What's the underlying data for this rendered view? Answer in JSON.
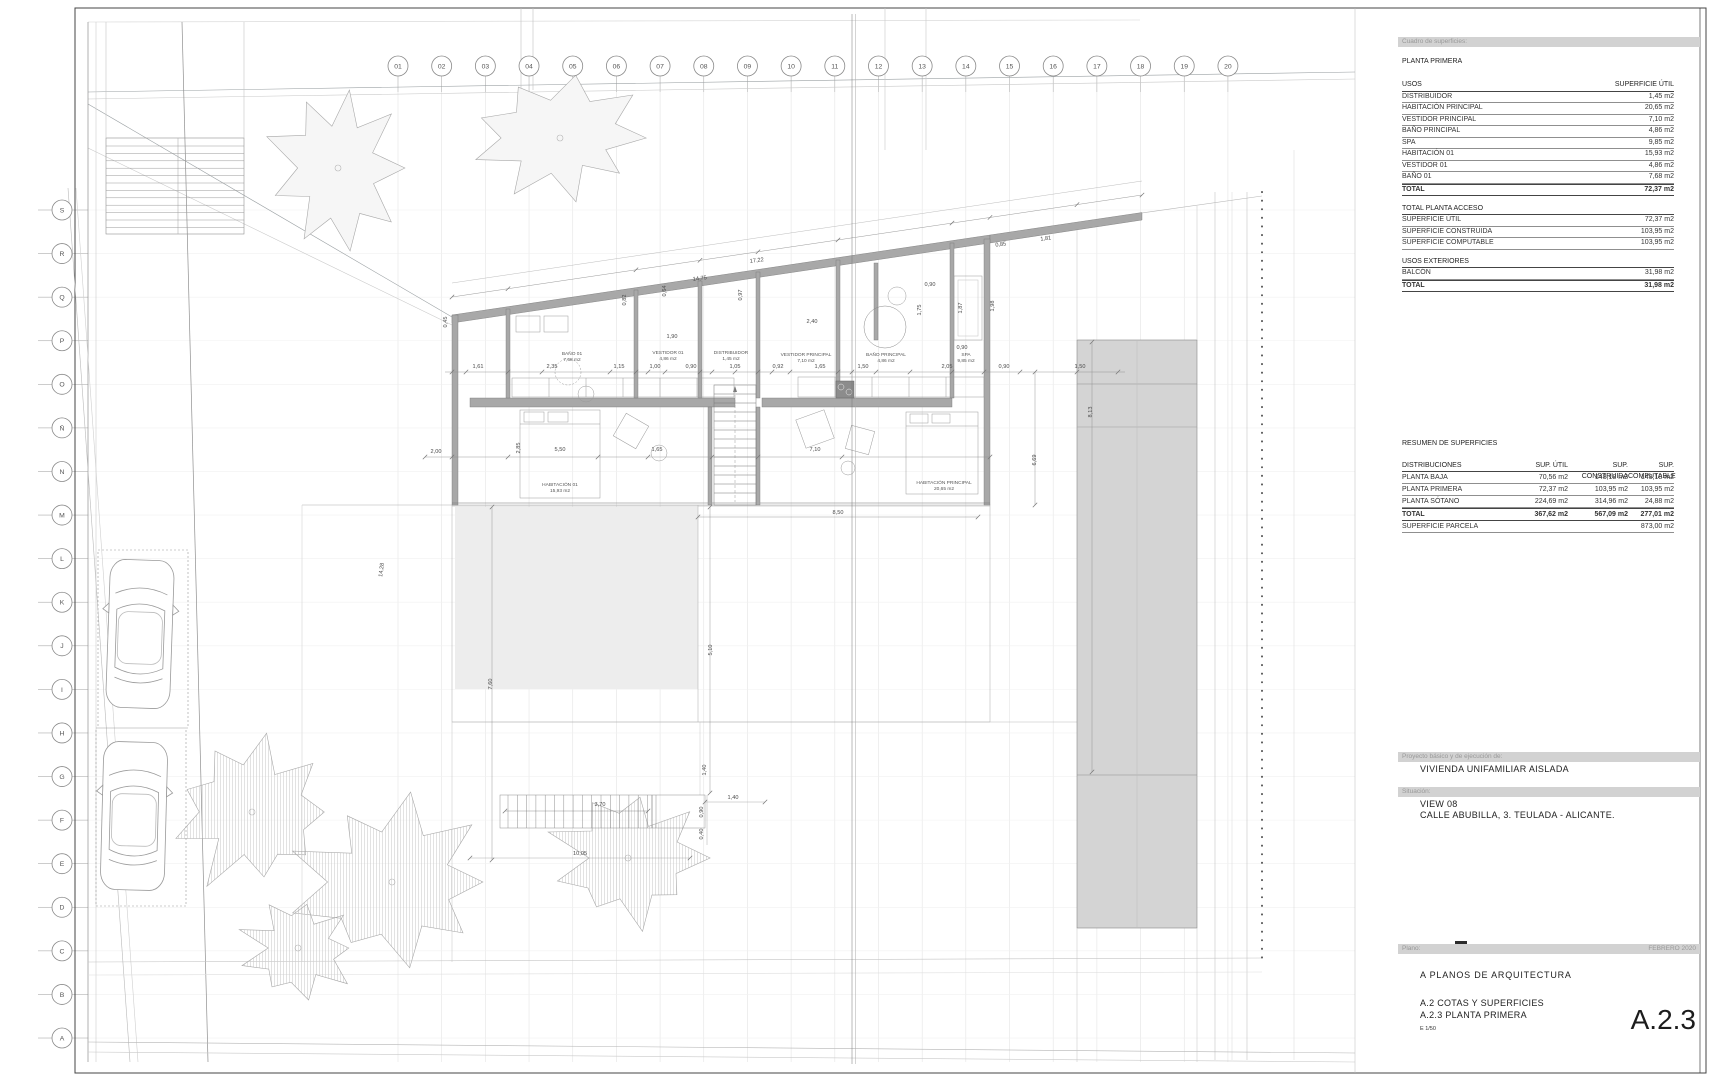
{
  "sheet": {
    "width": 1718,
    "height": 1080
  },
  "title_block": {
    "cuadro_label": "Cuadro de superficies:",
    "planta_title": "PLANTA PRIMERA",
    "usos_table": {
      "col1": "USOS",
      "col2": "SUPERFICIE ÚTIL",
      "rows": [
        [
          "DISTRIBUIDOR",
          "1,45 m2"
        ],
        [
          "HABITACIÓN PRINCIPAL",
          "20,65 m2"
        ],
        [
          "VESTIDOR PRINCIPAL",
          "7,10 m2"
        ],
        [
          "BAÑO PRINCIPAL",
          "4,86 m2"
        ],
        [
          "SPA",
          "9,85 m2"
        ],
        [
          "HABITACIÓN 01",
          "15,93 m2"
        ],
        [
          "VESTIDOR 01",
          "4,86 m2"
        ],
        [
          "BAÑO 01",
          "7,68 m2"
        ]
      ],
      "total": [
        "TOTAL",
        "72,37 m2"
      ]
    },
    "acceso_table": {
      "title": "TOTAL PLANTA ACCESO",
      "rows": [
        [
          "SUPERFICIE ÚTIL",
          "72,37 m2"
        ],
        [
          "SUPERFICIE CONSTRUIDA",
          "103,95 m2"
        ],
        [
          "SUPERFICIE COMPUTABLE",
          "103,95 m2"
        ]
      ]
    },
    "exteriores_table": {
      "title": "USOS EXTERIORES",
      "rows": [
        [
          "BALCÓN",
          "31,98 m2"
        ]
      ],
      "total": [
        "TOTAL",
        "31,98 m2"
      ]
    },
    "resumen_table": {
      "title": "RESUMEN DE SUPERFICIES",
      "headers": [
        "DISTRIBUCIONES",
        "SUP. ÚTIL",
        "SUP. CONSTRUIDA",
        "SUP. COMPUTABLE"
      ],
      "rows": [
        [
          "PLANTA BAJA",
          "70,56 m2",
          "148,18 m2",
          "148,18 m2"
        ],
        [
          "PLANTA PRIMERA",
          "72,37 m2",
          "103,95 m2",
          "103,95 m2"
        ],
        [
          "PLANTA SÓTANO",
          "224,69 m2",
          "314,96 m2",
          "24,88 m2"
        ]
      ],
      "total": [
        "TOTAL",
        "367,62 m2",
        "567,09 m2",
        "277,01 m2"
      ],
      "parcela": [
        "SUPERFICIE PARCELA",
        "",
        "",
        "873,00 m2"
      ]
    },
    "proyecto_label": "Proyecto básico y de ejecución de:",
    "proyecto_value": "VIVIENDA UNIFAMILIAR AISLADA",
    "situacion_label": "Situación:",
    "situacion_line1": "VIEW 08",
    "situacion_line2": "CALLE ABUBILLA, 3. TEULADA - ALICANTE.",
    "plano_label": "Plano:",
    "plano_date": "FEBRERO 2020",
    "series_title": "A  PLANOS DE ARQUITECTURA",
    "group_title": "A.2 COTAS Y SUPERFICIES",
    "sheet_title": "A.2.3 PLANTA PRIMERA",
    "scale": "E  1/50",
    "sheet_code": "A.2.3"
  },
  "grid": {
    "columns": [
      "01",
      "02",
      "03",
      "04",
      "05",
      "06",
      "07",
      "08",
      "09",
      "10",
      "11",
      "12",
      "13",
      "14",
      "15",
      "16",
      "17",
      "18",
      "19",
      "20"
    ],
    "rows": [
      "S",
      "R",
      "Q",
      "P",
      "O",
      "Ñ",
      "N",
      "M",
      "L",
      "K",
      "J",
      "I",
      "H",
      "G",
      "F",
      "E",
      "D",
      "C",
      "B",
      "A"
    ]
  },
  "plan": {
    "rooms": [
      {
        "name": "BAÑO 01",
        "area": "7,68 m2"
      },
      {
        "name": "VESTIDOR 01",
        "area": "4,86 m2"
      },
      {
        "name": "DISTRIBUIDOR",
        "area": "1,45 m2"
      },
      {
        "name": "HABITACIÓN 01",
        "area": "15,93 m2"
      },
      {
        "name": "VESTIDOR PRINCIPAL",
        "area": "7,10 m2"
      },
      {
        "name": "BAÑO PRINCIPAL",
        "area": "4,86 m2"
      },
      {
        "name": "SPA",
        "area": "9,85 m2"
      },
      {
        "name": "HABITACIÓN PRINCIPAL",
        "area": "20,65 m2"
      }
    ],
    "dims": [
      "14,75",
      "17,22",
      "0,85",
      "1,81",
      "1,61",
      "2,35",
      "1,15",
      "1,00",
      "0,90",
      "1,05",
      "1,90",
      "0,92",
      "1,65",
      "1,50",
      "2,05",
      "0,90",
      "1,50",
      "2,40",
      "0,90",
      "1,75",
      "1,87",
      "1,98",
      "0,90",
      "2,00",
      "5,50",
      "1,65",
      "7,10",
      "8,50",
      "2,85",
      "6,69",
      "8,13",
      "3,70",
      "1,40",
      "0,90",
      "0,40",
      "10,05",
      "5,10",
      "7,60",
      "1,40",
      "14,28",
      "0,45",
      "0,82",
      "0,97",
      "0,64"
    ]
  },
  "colors": {
    "wall": "#a8a8a8",
    "pool": "#d4d4d4",
    "bar": "#d2d2d2"
  }
}
